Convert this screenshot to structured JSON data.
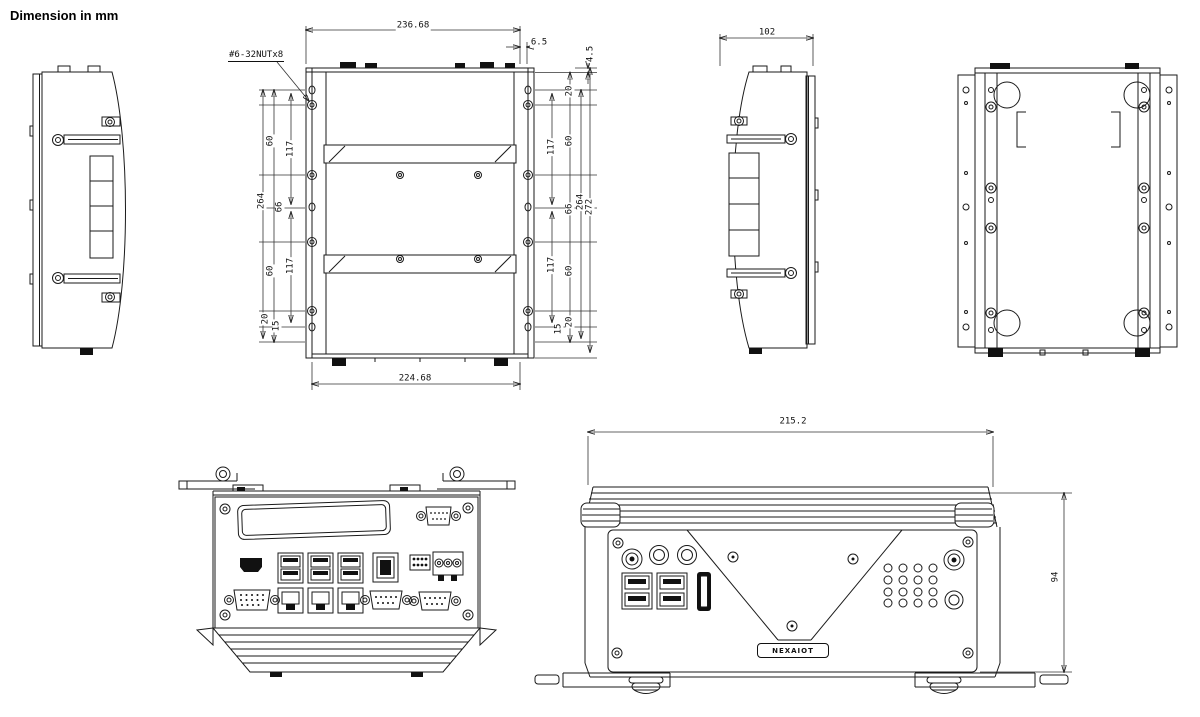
{
  "title": "Dimension in mm",
  "brand_logo": "NEXAIOT",
  "colors": {
    "line": "#1a1a1a",
    "fill": "#111111",
    "background": "#ffffff"
  },
  "dimensions": {
    "top_view": {
      "overall_width": "236.68",
      "mount_width": "224.68",
      "edge_offset_h": "6.5",
      "edge_offset_v": "4.5",
      "nut_callout": "#6-32NUTx8",
      "left_chain": [
        "60",
        "117",
        "66",
        "264",
        "60",
        "117",
        "20",
        "15"
      ],
      "right_chain": [
        "20",
        "60",
        "117",
        "66",
        "264",
        "272",
        "60",
        "117",
        "20",
        "15"
      ]
    },
    "side_view": {
      "depth": "102"
    },
    "front_view": {
      "width": "215.2",
      "height": "94"
    }
  }
}
